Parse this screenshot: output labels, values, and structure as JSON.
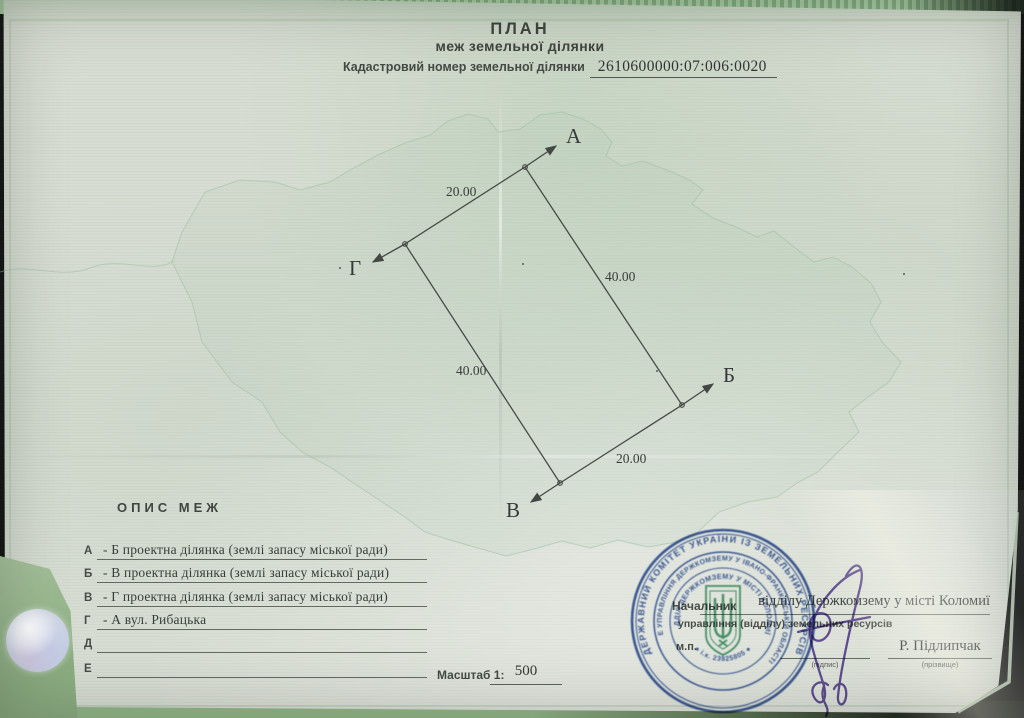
{
  "document": {
    "title": "ПЛАН",
    "subtitle": "меж земельної ділянки",
    "cadastral_label": "Кадастровий номер земельної ділянки",
    "cadastral_number": "2610600000:07:006:0020",
    "description_heading": "ОПИС МЕЖ",
    "boundaries": [
      {
        "letter": "А",
        "text": "- Б проектна ділянка (землі запасу міської ради)"
      },
      {
        "letter": "Б",
        "text": "- В проектна ділянка (землі запасу міської ради)"
      },
      {
        "letter": "В",
        "text": "- Г проектна ділянка (землі запасу міської ради)"
      },
      {
        "letter": "Г",
        "text": "- А вул. Рибацька"
      },
      {
        "letter": "Д",
        "text": ""
      },
      {
        "letter": "Е",
        "text": ""
      }
    ],
    "scale_label": "Масштаб 1:",
    "scale_value": "500"
  },
  "plan_diagram": {
    "points": [
      {
        "name": "А"
      },
      {
        "name": "Б"
      },
      {
        "name": "В"
      },
      {
        "name": "Г"
      }
    ],
    "sides": [
      {
        "from": "А",
        "to": "Г",
        "length": "20.00"
      },
      {
        "from": "А",
        "to": "Б",
        "length": "40.00"
      },
      {
        "from": "Г",
        "to": "В",
        "length": "40.00"
      },
      {
        "from": "В",
        "to": "Б",
        "length": "20.00"
      }
    ]
  },
  "approval": {
    "official_label": "Начальник",
    "office_filled": "відділу Держкомзему у місті Коломиї",
    "office_label": "управління (відділу) земельних ресурсів",
    "seal_place_label": "м.п.",
    "signature_caption": "(підпис)",
    "name": "Р. Підлипчак",
    "name_caption": "(прізвище)"
  },
  "stamp": {
    "outer_text": "ДЕРЖАВНИЙ КОМІТЕТ УКРАЇНИ ІЗ ЗЕМЕЛЬНИХ РЕСУРСІВ",
    "middle_text": "ГОЛОВНЕ УПРАВЛІННЯ ДЕРЖКОМЗЕМУ У ІВАНО-ФРАНКІВСЬКІЙ ОБЛАСТІ",
    "inner_text": "ВІДДІЛ ДЕРЖКОМЗЕМУ У МІСТІ КОЛОМИЇ",
    "id_code": "● і.к. 23925805 ●"
  },
  "colors": {
    "paper": "#d8ddd3",
    "ink": "#3a3f3a",
    "stamp_ink": "#2d4f9e",
    "emblem_green": "#3d9468",
    "signature_ink": "#5a3f9c",
    "folder_green": "#8fb684",
    "backdrop": "#171917",
    "hologram": "#dde2ec"
  }
}
